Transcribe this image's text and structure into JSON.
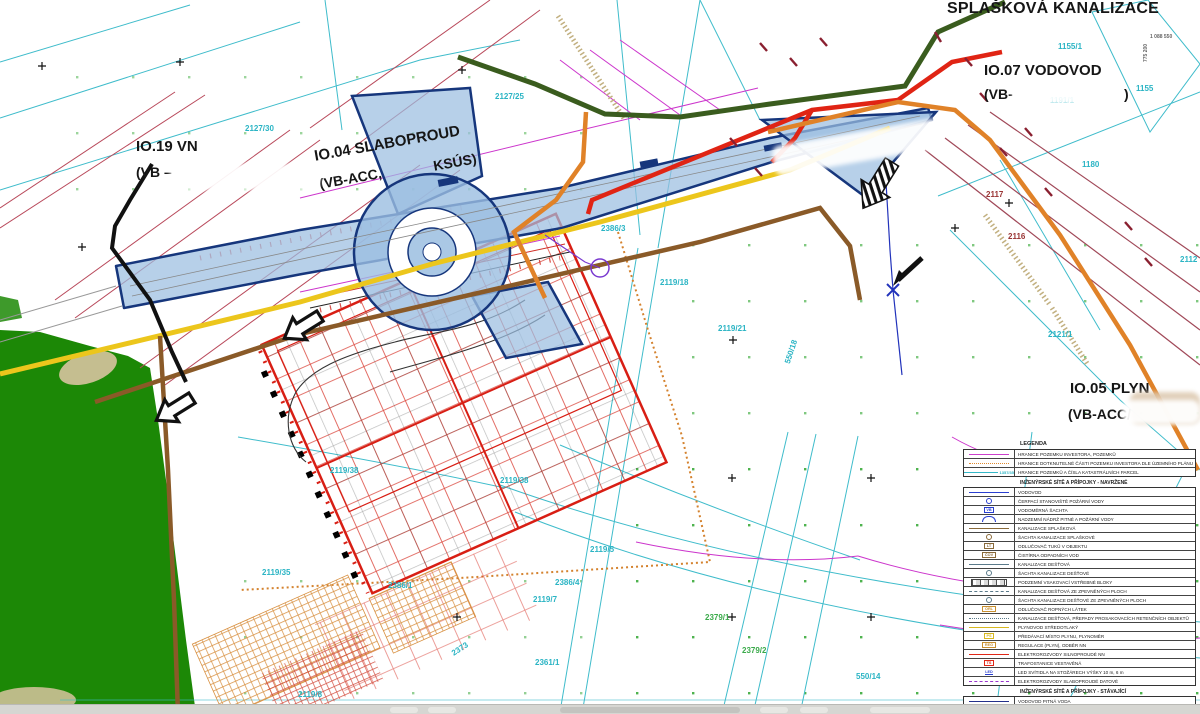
{
  "labels": {
    "splaskova": "SPLAŠKOVÁ KANALIZACE",
    "io07_title": "IO.07 VODOVOD",
    "io07_sub_open": "(VB-",
    "io07_sub_close": ")",
    "io19_title": "IO.19 VN",
    "io19_sub": "(VB –",
    "io04_title": "IO.04 SLABOPROUD",
    "io04_sub": "(VB-ACC,",
    "io04_sub2": "KSÚS)",
    "io05_title": "IO.05 PLYN",
    "io05_sub": "(VB-ACC/",
    "coord_x": "775 200",
    "coord_y": "1 088 550"
  },
  "parcels": [
    {
      "t": "2127/30",
      "x": 245,
      "y": 124,
      "c": "#2ab4c4"
    },
    {
      "t": "2127/25",
      "x": 495,
      "y": 92,
      "c": "#2ab4c4"
    },
    {
      "t": "2119/18",
      "x": 660,
      "y": 278,
      "c": "#2ab4c4"
    },
    {
      "t": "2119/21",
      "x": 718,
      "y": 324,
      "c": "#2ab4c4"
    },
    {
      "t": "550/18",
      "x": 783,
      "y": 362,
      "c": "#2ab4c4",
      "r": -72
    },
    {
      "t": "2386/3",
      "x": 601,
      "y": 224,
      "c": "#2ab4c4"
    },
    {
      "t": "2119/38",
      "x": 500,
      "y": 476,
      "c": "#2ab4c4"
    },
    {
      "t": "2119/38",
      "x": 330,
      "y": 466,
      "c": "#2ab4c4"
    },
    {
      "t": "2119/35",
      "x": 262,
      "y": 568,
      "c": "#2ab4c4"
    },
    {
      "t": "2119/5",
      "x": 590,
      "y": 545,
      "c": "#2ab4c4"
    },
    {
      "t": "2386/4",
      "x": 555,
      "y": 578,
      "c": "#2ab4c4"
    },
    {
      "t": "2119/7",
      "x": 533,
      "y": 595,
      "c": "#2ab4c4"
    },
    {
      "t": "2361/1",
      "x": 535,
      "y": 658,
      "c": "#2ab4c4"
    },
    {
      "t": "2386/1",
      "x": 388,
      "y": 581,
      "c": "#2ab4c4"
    },
    {
      "t": "2373",
      "x": 450,
      "y": 650,
      "c": "#2ab4c4",
      "r": -33
    },
    {
      "t": "2119/8",
      "x": 298,
      "y": 690,
      "c": "#2ab4c4"
    },
    {
      "t": "2379/1",
      "x": 705,
      "y": 613,
      "c": "#3aaa4a"
    },
    {
      "t": "2379/2",
      "x": 742,
      "y": 646,
      "c": "#3aaa4a"
    },
    {
      "t": "550/14",
      "x": 856,
      "y": 672,
      "c": "#2ab4c4"
    },
    {
      "t": "1155",
      "x": 1136,
      "y": 84,
      "c": "#2ab4c4"
    },
    {
      "t": "1155/1",
      "x": 1058,
      "y": 42,
      "c": "#2ab4c4"
    },
    {
      "t": "1191/1",
      "x": 1050,
      "y": 96,
      "c": "#2ab4c4"
    },
    {
      "t": "1180",
      "x": 1082,
      "y": 160,
      "c": "#2ab4c4"
    },
    {
      "t": "2117",
      "x": 986,
      "y": 190,
      "c": "#993333"
    },
    {
      "t": "2116",
      "x": 1008,
      "y": 232,
      "c": "#993333"
    },
    {
      "t": "2121/1",
      "x": 1048,
      "y": 330,
      "c": "#2ab4c4"
    },
    {
      "t": "2112",
      "x": 1180,
      "y": 255,
      "c": "#2ab4c4"
    }
  ],
  "legend": {
    "title": "LEGENDA",
    "groups": [
      {
        "header": "",
        "rows": [
          {
            "sym": "line",
            "color": "#cc3fcc",
            "label": "HRANICE POZEMKU INVESTORA, POZEMKŮ"
          },
          {
            "sym": "dashdot",
            "color": "#e08a30",
            "label": "HRANICE DOTKNUTELNÉ ČÁSTI POZEMKU INVESTORA DLE ÚZEMNÍHO PLÁNU"
          },
          {
            "sym": "line",
            "color": "#35b8c8",
            "text": "1357/35",
            "label": "HRANICE POZEMKŮ A ČÍSLA KATASTRÁLNÍCH PARCEL"
          }
        ]
      },
      {
        "header": "INŽENÝRSKÉ SÍTĚ A PŘÍPOJKY - NAVRŽENÉ",
        "rows": [
          {
            "sym": "line",
            "color": "#2a3fd0",
            "label": "VODOVOD"
          },
          {
            "sym": "circle",
            "color": "#2a3fd0",
            "label": "ČERPACÍ STANOVIŠTĚ POŽÁRNÍ VODY"
          },
          {
            "sym": "box",
            "color": "#2a3fd0",
            "text": "VB",
            "label": "VODOMĚRNÁ ŠACHTA"
          },
          {
            "sym": "arc",
            "color": "#2a3fd0",
            "label": "NADZEMNÍ NÁDRŽ PITNÉ A POŽÁRNÍ VODY"
          },
          {
            "sym": "line",
            "color": "#8a6a3a",
            "label": "KANALIZACE SPLAŠKOVÁ"
          },
          {
            "sym": "circle",
            "color": "#8a6a3a",
            "label": "ŠACHTA KANALIZACE SPLAŠKOVÉ"
          },
          {
            "sym": "box",
            "color": "#8a6a3a",
            "text": "LT",
            "label": "ODLUČOVAČ TUKŮ V OBJEKTU"
          },
          {
            "sym": "box",
            "color": "#8a6a3a",
            "text": "ČOV",
            "label": "ČISTÍRNA ODPADNÍCH VOD"
          },
          {
            "sym": "line",
            "color": "#5a7a8a",
            "label": "KANALIZACE DEŠŤOVÁ"
          },
          {
            "sym": "circle",
            "color": "#5a7a8a",
            "label": "ŠACHTA KANALIZACE DEŠŤOVÉ"
          },
          {
            "sym": "blocks",
            "color": "#555555",
            "label": "PODZEMNÍ VSAKOVACÍ VSTŘEBNÉ BLOKY"
          },
          {
            "sym": "dash",
            "color": "#5a7a8a",
            "label": "KANALIZACE DEŠŤOVÁ ZE ZPEVNĚNÝCH PLOCH"
          },
          {
            "sym": "circle",
            "color": "#5a7a8a",
            "label": "ŠACHTA KANALIZACE DEŠŤOVÉ ZE ZPEVNĚNÝCH PLOCH"
          },
          {
            "sym": "box",
            "color": "#c89030",
            "text": "ORL",
            "label": "ODLUČOVAČ ROPNÝCH LÁTEK"
          },
          {
            "sym": "dashdot",
            "color": "#5a7a8a",
            "label": "KANALIZACE DEŠŤOVÁ, PŘEPADY PROSAKOVACÍCH RETENČNÍCH OBJEKTŮ"
          },
          {
            "sym": "line",
            "color": "#d8b820",
            "label": "PLYNOVOD STŘEDOTLAKÝ"
          },
          {
            "sym": "box",
            "color": "#d8b820",
            "text": "PS",
            "label": "PŘEDÁVACÍ MÍSTO PLYNU, PLYNOMĚR"
          },
          {
            "sym": "box",
            "color": "#c89030",
            "text": "REG",
            "label": "REGULACE (PLYN), ODBĚR NN"
          },
          {
            "sym": "line",
            "color": "#e02818",
            "label": "ELEKTROROZVODY SILNOPROUDÉ NN"
          },
          {
            "sym": "box",
            "color": "#e02818",
            "text": "TS",
            "label": "TRAFOSTANICE VESTAVĚNÁ"
          },
          {
            "sym": "leds",
            "color": "#2a3fd0",
            "text": "LED",
            "label": "LED SVÍTIDLA NA STOŽÁRECH VÝŠKY 10 m, 6 m"
          },
          {
            "sym": "dash",
            "color": "#9a35cc",
            "label": "ELEKTROROZVODY SLABOPROUDÉ DATOVÉ"
          }
        ]
      },
      {
        "header": "INŽENÝRSKÉ SÍTĚ A PŘÍPOJKY - STÁVAJÍCÍ",
        "rows": [
          {
            "sym": "line",
            "color": "#24308a",
            "label": "VODOVOD PITNÁ VODA"
          },
          {
            "sym": "line",
            "color": "#9aa825",
            "label": "PLYNOVOD VYSOKOTLAKÝ"
          },
          {
            "sym": "hatch",
            "color": "#3a8a2a",
            "label": "OCHRANNÉ A BEZPEČNOSTNÍ PÁSMO VYSOKOTLAKÉHO PLYNOVODU"
          }
        ]
      }
    ]
  }
}
